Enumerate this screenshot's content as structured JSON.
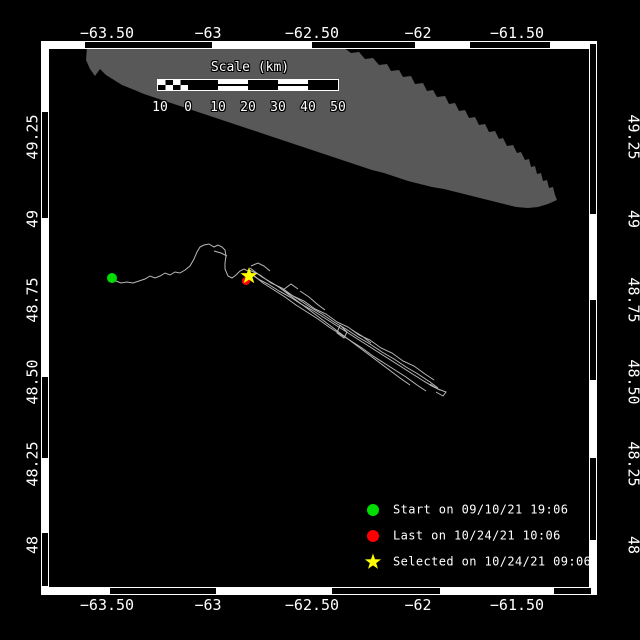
{
  "figure": {
    "type": "drifter-track-map",
    "background": "#000000",
    "frame": {
      "x0": 41,
      "y0": 41,
      "x1": 597,
      "y1": 595,
      "band": 8,
      "top_black_segments": [
        [
          85,
          212
        ],
        [
          312,
          415
        ],
        [
          470,
          550
        ]
      ],
      "bottom_black_segments": [
        [
          110,
          216
        ],
        [
          332,
          440
        ],
        [
          554,
          591
        ]
      ],
      "left_black_segments": [
        [
          112,
          218
        ],
        [
          377,
          458
        ],
        [
          533,
          586
        ]
      ],
      "right_black_segments": [
        [
          44,
          214
        ],
        [
          300,
          380
        ],
        [
          458,
          540
        ]
      ]
    }
  },
  "colors": {
    "land": "#585858",
    "track": "#b8b8b8",
    "start_marker": "#00dd00",
    "last_marker": "#ff0000",
    "selected_marker": "#ffff00",
    "text": "#ffffff"
  },
  "axes": {
    "top": [
      {
        "text": "−63.50",
        "x": 107
      },
      {
        "text": "−63",
        "x": 208
      },
      {
        "text": "−62.50",
        "x": 312
      },
      {
        "text": "−62",
        "x": 418
      },
      {
        "text": "−61.50",
        "x": 517
      }
    ],
    "bottom": [
      {
        "text": "−63.50",
        "x": 107
      },
      {
        "text": "−63",
        "x": 208
      },
      {
        "text": "−62.50",
        "x": 312
      },
      {
        "text": "−62",
        "x": 418
      },
      {
        "text": "−61.50",
        "x": 517
      }
    ],
    "left": [
      {
        "text": "49.25",
        "y": 137
      },
      {
        "text": "49",
        "y": 219
      },
      {
        "text": "48.75",
        "y": 300
      },
      {
        "text": "48.50",
        "y": 382
      },
      {
        "text": "48.25",
        "y": 464
      },
      {
        "text": "48",
        "y": 545
      }
    ],
    "right": [
      {
        "text": "49.25",
        "y": 137
      },
      {
        "text": "49",
        "y": 219
      },
      {
        "text": "48.75",
        "y": 300
      },
      {
        "text": "48.50",
        "y": 382
      },
      {
        "text": "48.25",
        "y": 464
      },
      {
        "text": "48",
        "y": 545
      }
    ]
  },
  "scalebar": {
    "title": "Scale (km)",
    "segments": [
      "checker",
      "black",
      "striped",
      "black",
      "striped",
      "black"
    ],
    "tick_labels": [
      {
        "text": "10",
        "x": 160
      },
      {
        "text": "0",
        "x": 188
      },
      {
        "text": "10",
        "x": 218
      },
      {
        "text": "20",
        "x": 248
      },
      {
        "text": "30",
        "x": 278
      },
      {
        "text": "40",
        "x": 308
      },
      {
        "text": "50",
        "x": 338
      }
    ]
  },
  "legend": {
    "items": [
      {
        "id": "start",
        "marker": "circle",
        "color": "#00dd00",
        "label": "Start on 09/10/21 19:06",
        "y": 510
      },
      {
        "id": "last",
        "marker": "circle",
        "color": "#ff0000",
        "label": "Last on 10/24/21 10:06",
        "y": 536
      },
      {
        "id": "selected",
        "marker": "star",
        "color": "#ffff00",
        "label": "Selected on 10/24/21 09:06",
        "y": 562
      }
    ],
    "marker_x": 373
  },
  "markers": {
    "start": {
      "x": 112,
      "y": 278,
      "r": 5
    },
    "last": {
      "x": 246,
      "y": 281,
      "r": 4
    },
    "selected": {
      "x": 249,
      "y": 276,
      "outer_r": 9,
      "inner_r": 3.6
    }
  },
  "land": {
    "points": [
      [
        87,
        47
      ],
      [
        343,
        47
      ],
      [
        351,
        53
      ],
      [
        359,
        52
      ],
      [
        365,
        59
      ],
      [
        373,
        58
      ],
      [
        379,
        65
      ],
      [
        387,
        64
      ],
      [
        391,
        71
      ],
      [
        399,
        70
      ],
      [
        403,
        77
      ],
      [
        411,
        76
      ],
      [
        415,
        84
      ],
      [
        423,
        83
      ],
      [
        427,
        91
      ],
      [
        433,
        90
      ],
      [
        437,
        97
      ],
      [
        445,
        96
      ],
      [
        449,
        104
      ],
      [
        455,
        103
      ],
      [
        459,
        111
      ],
      [
        465,
        110
      ],
      [
        469,
        118
      ],
      [
        475,
        117
      ],
      [
        479,
        125
      ],
      [
        485,
        124
      ],
      [
        489,
        132
      ],
      [
        495,
        131
      ],
      [
        499,
        139
      ],
      [
        503,
        138
      ],
      [
        507,
        146
      ],
      [
        513,
        145
      ],
      [
        517,
        153
      ],
      [
        521,
        152
      ],
      [
        525,
        160
      ],
      [
        529,
        159
      ],
      [
        531,
        167
      ],
      [
        535,
        166
      ],
      [
        537,
        174
      ],
      [
        541,
        173
      ],
      [
        543,
        181
      ],
      [
        547,
        180
      ],
      [
        549,
        188
      ],
      [
        553,
        187
      ],
      [
        555,
        195
      ],
      [
        557,
        200
      ],
      [
        548,
        204
      ],
      [
        538,
        207
      ],
      [
        528,
        208
      ],
      [
        516,
        207
      ],
      [
        504,
        204
      ],
      [
        492,
        201
      ],
      [
        480,
        198
      ],
      [
        468,
        195
      ],
      [
        456,
        192
      ],
      [
        444,
        189
      ],
      [
        432,
        187
      ],
      [
        420,
        184
      ],
      [
        408,
        181
      ],
      [
        396,
        177
      ],
      [
        384,
        173
      ],
      [
        372,
        170
      ],
      [
        360,
        166
      ],
      [
        348,
        162
      ],
      [
        336,
        158
      ],
      [
        324,
        154
      ],
      [
        312,
        150
      ],
      [
        300,
        146
      ],
      [
        288,
        142
      ],
      [
        276,
        138
      ],
      [
        264,
        134
      ],
      [
        252,
        130
      ],
      [
        240,
        126
      ],
      [
        228,
        122
      ],
      [
        216,
        118
      ],
      [
        204,
        114
      ],
      [
        192,
        110
      ],
      [
        180,
        106
      ],
      [
        168,
        102
      ],
      [
        156,
        98
      ],
      [
        144,
        94
      ],
      [
        132,
        89
      ],
      [
        122,
        85
      ],
      [
        114,
        80
      ],
      [
        106,
        75
      ],
      [
        100,
        69
      ],
      [
        95,
        76
      ],
      [
        90,
        69
      ],
      [
        86,
        60
      ]
    ]
  },
  "track": {
    "main": [
      [
        112,
        278
      ],
      [
        116,
        281
      ],
      [
        121,
        283
      ],
      [
        127,
        282
      ],
      [
        133,
        283
      ],
      [
        139,
        281
      ],
      [
        145,
        279
      ],
      [
        150,
        276
      ],
      [
        155,
        278
      ],
      [
        160,
        276
      ],
      [
        165,
        273
      ],
      [
        170,
        275
      ],
      [
        175,
        272
      ],
      [
        180,
        273
      ],
      [
        185,
        270
      ],
      [
        190,
        266
      ],
      [
        194,
        259
      ],
      [
        197,
        252
      ],
      [
        200,
        247
      ],
      [
        204,
        245
      ],
      [
        209,
        244
      ],
      [
        214,
        247
      ],
      [
        218,
        245
      ],
      [
        222,
        247
      ],
      [
        225,
        250
      ],
      [
        226,
        256
      ],
      [
        225,
        263
      ],
      [
        225,
        269
      ],
      [
        228,
        276
      ],
      [
        232,
        278
      ],
      [
        236,
        275
      ],
      [
        240,
        271
      ],
      [
        244,
        269
      ],
      [
        248,
        271
      ]
    ],
    "strands": [
      [
        [
          248,
          272
        ],
        [
          258,
          279
        ],
        [
          268,
          284
        ],
        [
          279,
          291
        ],
        [
          290,
          297
        ],
        [
          301,
          304
        ],
        [
          312,
          310
        ],
        [
          323,
          317
        ],
        [
          334,
          324
        ],
        [
          345,
          331
        ],
        [
          356,
          338
        ],
        [
          367,
          345
        ],
        [
          378,
          352
        ],
        [
          389,
          359
        ],
        [
          400,
          366
        ],
        [
          411,
          373
        ],
        [
          422,
          380
        ],
        [
          432,
          386
        ],
        [
          440,
          390
        ]
      ],
      [
        [
          250,
          268
        ],
        [
          262,
          277
        ],
        [
          274,
          284
        ],
        [
          286,
          292
        ],
        [
          298,
          299
        ],
        [
          310,
          307
        ],
        [
          322,
          314
        ],
        [
          334,
          322
        ],
        [
          346,
          329
        ],
        [
          358,
          337
        ],
        [
          370,
          344
        ],
        [
          382,
          352
        ],
        [
          394,
          359
        ],
        [
          406,
          367
        ],
        [
          418,
          374
        ],
        [
          430,
          382
        ],
        [
          438,
          388
        ]
      ],
      [
        [
          252,
          274
        ],
        [
          263,
          283
        ],
        [
          274,
          290
        ],
        [
          285,
          297
        ],
        [
          296,
          305
        ],
        [
          307,
          312
        ],
        [
          318,
          319
        ],
        [
          329,
          327
        ],
        [
          340,
          334
        ],
        [
          351,
          341
        ],
        [
          362,
          348
        ],
        [
          373,
          356
        ],
        [
          384,
          363
        ],
        [
          395,
          370
        ],
        [
          406,
          377
        ],
        [
          417,
          385
        ],
        [
          426,
          391
        ]
      ],
      [
        [
          249,
          270
        ],
        [
          260,
          275
        ],
        [
          271,
          283
        ],
        [
          282,
          288
        ],
        [
          293,
          296
        ],
        [
          304,
          301
        ],
        [
          315,
          309
        ],
        [
          326,
          314
        ],
        [
          337,
          322
        ],
        [
          348,
          327
        ],
        [
          359,
          335
        ],
        [
          370,
          340
        ],
        [
          381,
          348
        ],
        [
          392,
          353
        ],
        [
          403,
          361
        ],
        [
          414,
          366
        ],
        [
          425,
          374
        ],
        [
          434,
          380
        ]
      ],
      [
        [
          280,
          288
        ],
        [
          292,
          297
        ],
        [
          304,
          306
        ],
        [
          316,
          315
        ],
        [
          328,
          324
        ],
        [
          340,
          333
        ],
        [
          352,
          342
        ],
        [
          364,
          351
        ],
        [
          376,
          360
        ],
        [
          388,
          369
        ],
        [
          400,
          378
        ],
        [
          410,
          385
        ]
      ],
      [
        [
          340,
          325
        ],
        [
          347,
          332
        ],
        [
          344,
          338
        ],
        [
          337,
          333
        ],
        [
          340,
          325
        ]
      ],
      [
        [
          214,
          251
        ],
        [
          221,
          253
        ],
        [
          227,
          256
        ]
      ],
      [
        [
          251,
          266
        ],
        [
          258,
          263
        ],
        [
          264,
          266
        ],
        [
          270,
          271
        ]
      ],
      [
        [
          300,
          291
        ],
        [
          309,
          297
        ],
        [
          317,
          304
        ],
        [
          325,
          310
        ]
      ],
      [
        [
          352,
          330
        ],
        [
          362,
          336
        ],
        [
          371,
          343
        ]
      ],
      [
        [
          430,
          384
        ],
        [
          438,
          389
        ],
        [
          446,
          392
        ],
        [
          443,
          396
        ],
        [
          436,
          392
        ]
      ],
      [
        [
          283,
          290
        ],
        [
          291,
          284
        ],
        [
          298,
          289
        ]
      ]
    ]
  }
}
